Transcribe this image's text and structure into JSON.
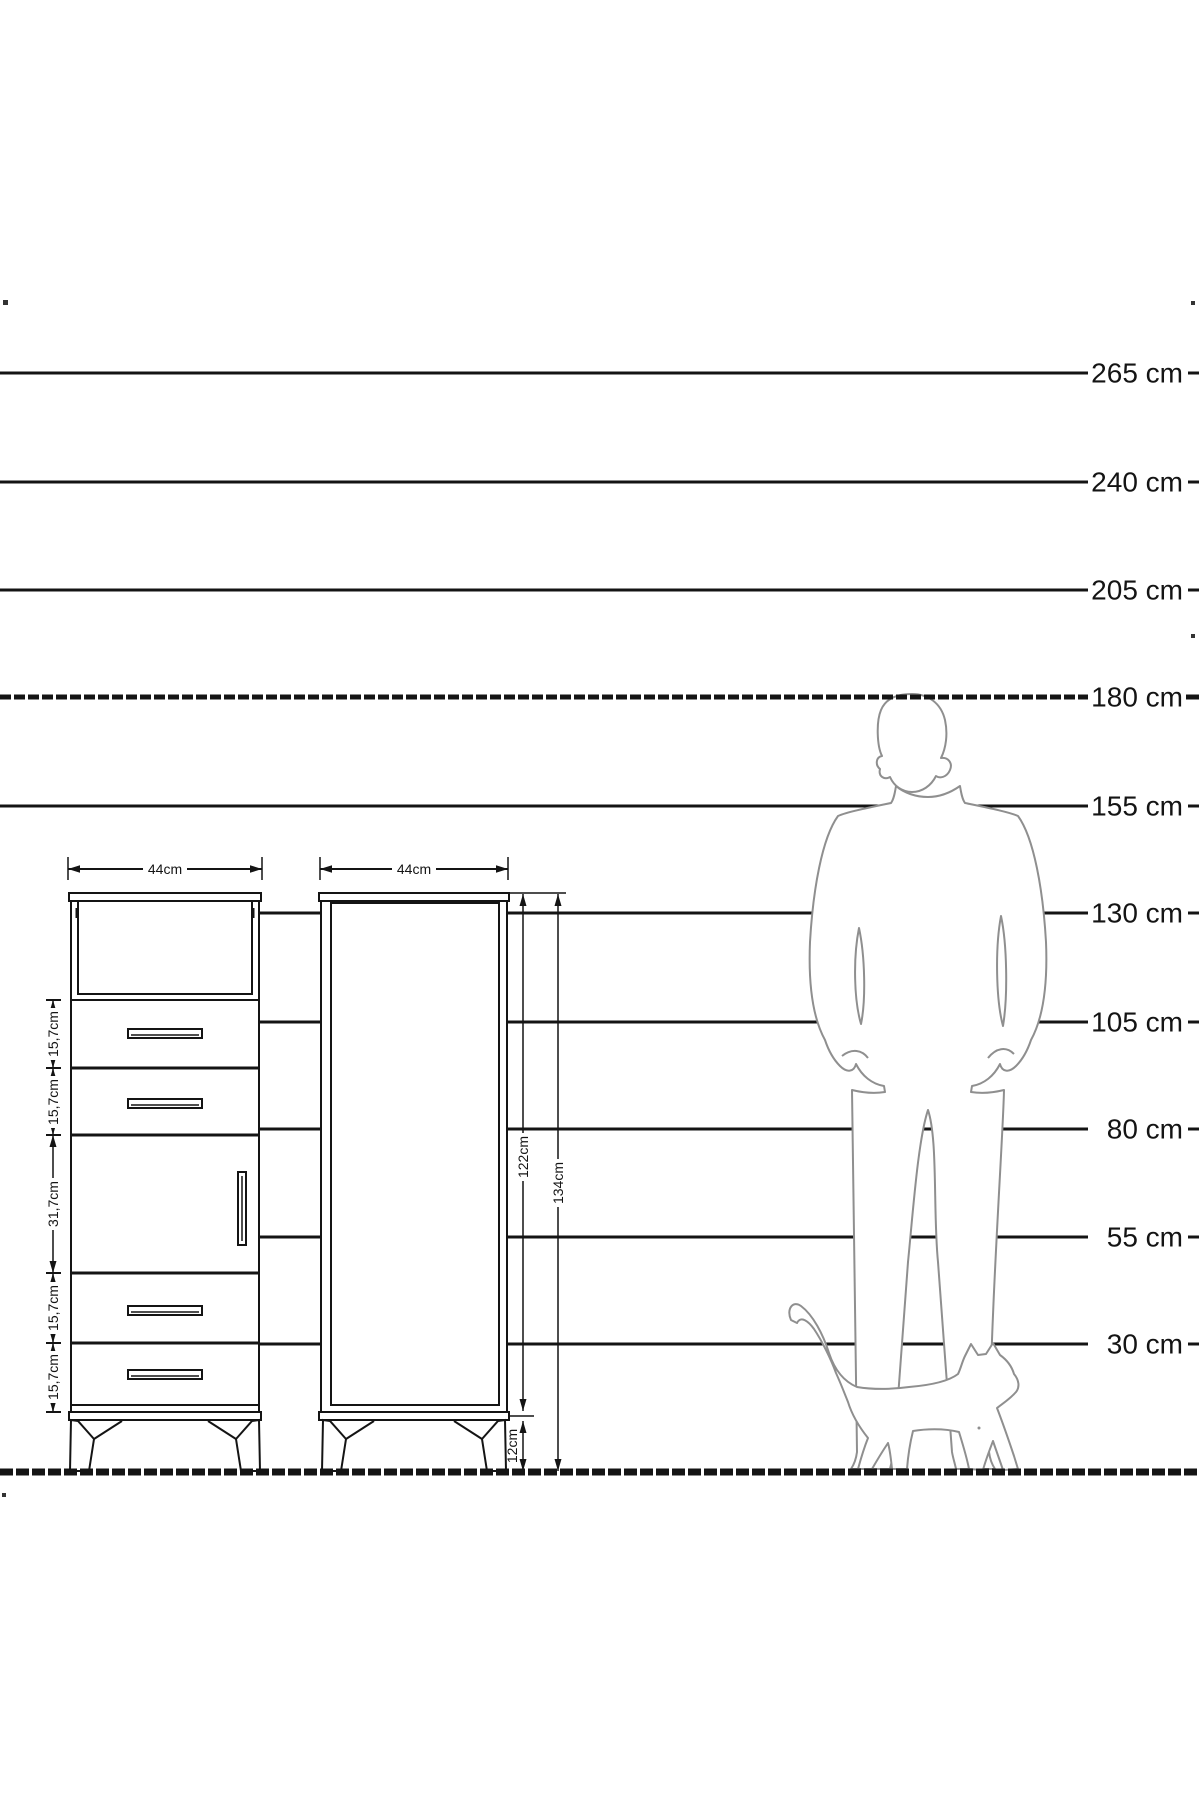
{
  "scale": {
    "unit": "cm",
    "labels": [
      "265 cm",
      "240 cm",
      "205 cm",
      "180 cm",
      "155 cm",
      "130 cm",
      "105 cm",
      "80 cm",
      "55 cm",
      "30 cm"
    ]
  },
  "left_cabinet": {
    "width_label": "44cm",
    "section_labels": [
      "15,7cm",
      "15,7cm",
      "31,7cm",
      "15,7cm",
      "15,7cm"
    ],
    "sections": [
      "open shelf",
      "drawer",
      "drawer",
      "door",
      "drawer",
      "drawer"
    ]
  },
  "right_cabinet": {
    "width_label": "44cm",
    "body_height_label": "122cm",
    "total_height_label": "134cm",
    "leg_height_label": "12cm"
  }
}
